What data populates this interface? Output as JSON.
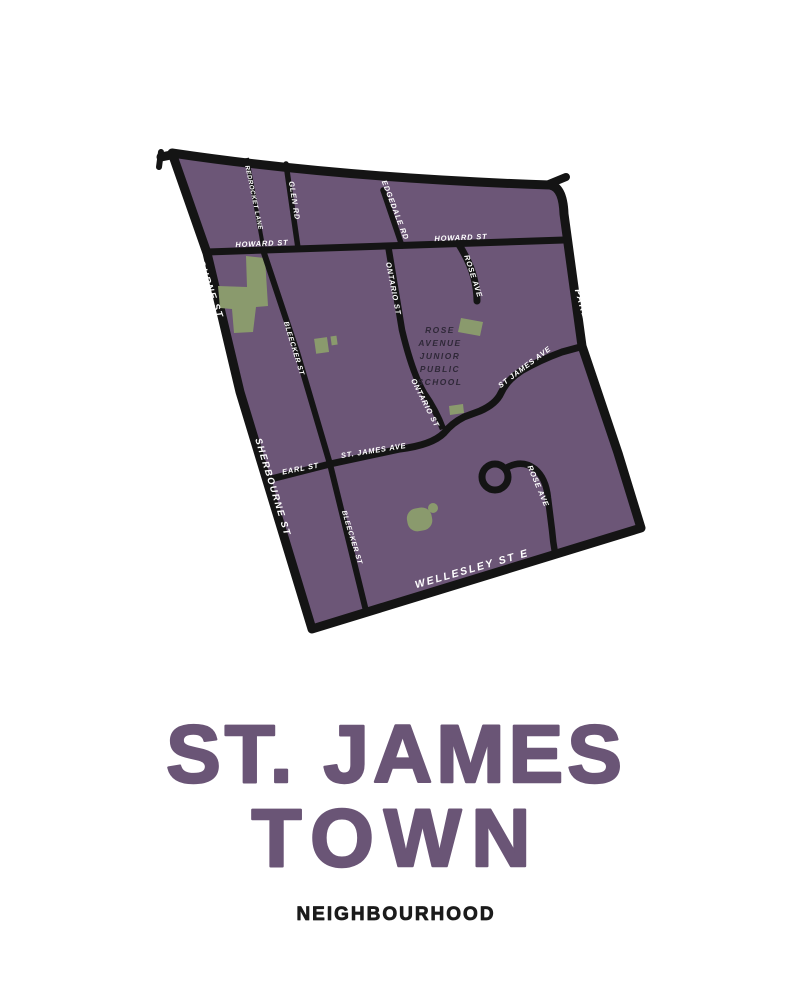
{
  "poster": {
    "title_line1": "ST. JAMES",
    "title_line2": "TOWN",
    "subtitle": "NEIGHBOURHOOD"
  },
  "colors": {
    "background": "#FFFFFF",
    "neighbourhood_fill": "#6C5677",
    "road_black": "#141414",
    "park_green": "#8A9A6D",
    "street_label_white": "#FFFFFF",
    "school_label_dark": "#2F2838",
    "title_purple": "#6A5576",
    "subtitle_black": "#1B1B1B"
  },
  "map": {
    "street_labels": {
      "bloor": "BLOOR ST E",
      "sherbourne_upper": "SHERBOURNE ST",
      "sherbourne_lower": "SHERBOURNE ST",
      "parliament": "PARLIAMENT ST",
      "wellesley": "WELLESLEY ST E",
      "howard_left": "HOWARD ST",
      "howard_right": "HOWARD ST",
      "redrocket": "REDROCKET LANE",
      "glen": "GLEN RD",
      "edgedale": "EDGEDALE RD",
      "ontario_upper": "ONTARIO ST",
      "ontario_lower": "ONTARIO ST",
      "rose_upper": "ROSE AVE",
      "rose_lower": "ROSE AVE",
      "st_james_upper": "ST JAMES AVE",
      "st_james_lower": "ST. JAMES AVE",
      "earl": "EARL ST",
      "bleecker_upper": "BLEECKER ST",
      "bleecker_lower": "BLEECKER ST"
    },
    "school_label_lines": [
      "ROSE",
      "AVENUE",
      "JUNIOR",
      "PUBLIC",
      "SCHOOL"
    ]
  }
}
